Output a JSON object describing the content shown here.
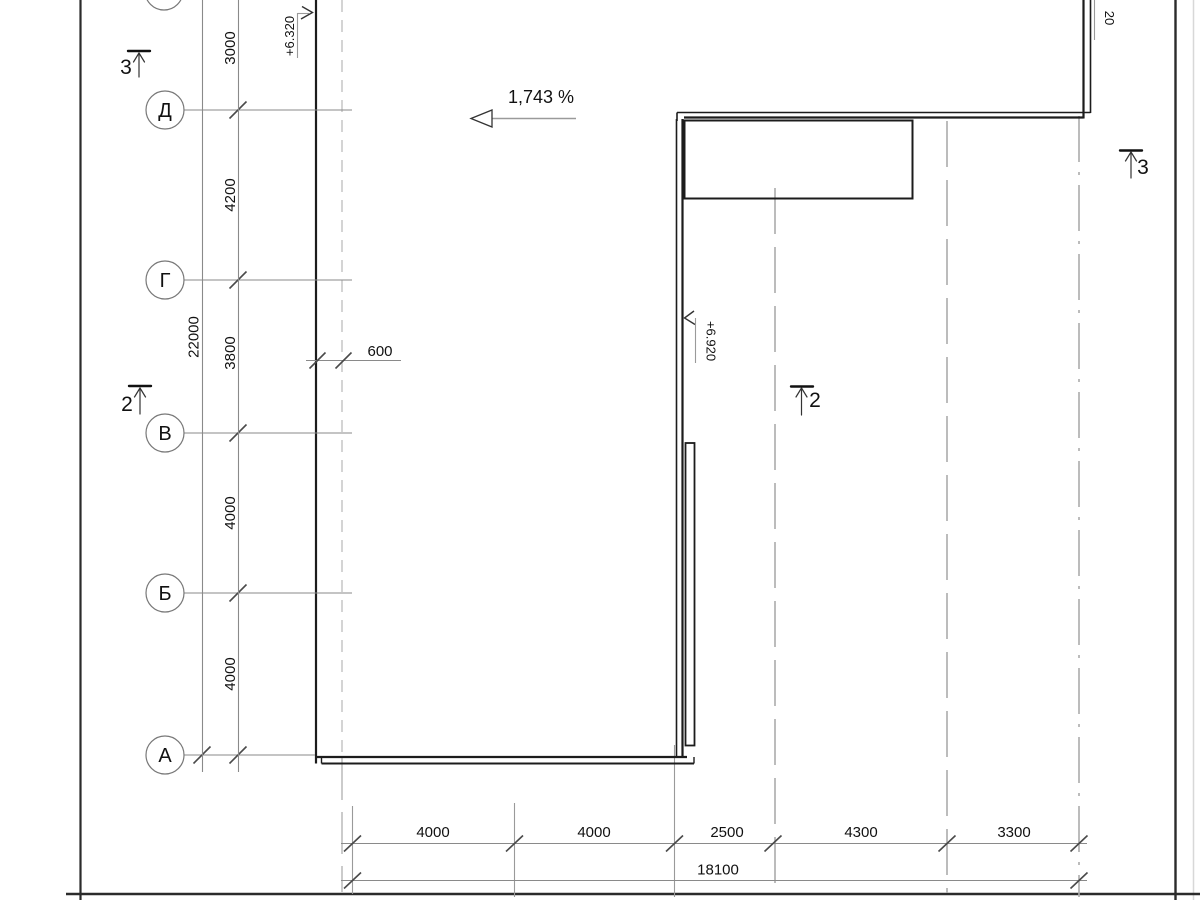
{
  "axes": {
    "row_labels": [
      "Д",
      "Г",
      "В",
      "Б",
      "А"
    ]
  },
  "left_dims": {
    "segments": [
      "3000",
      "4200",
      "3800",
      "4000",
      "4000"
    ],
    "total": "22000"
  },
  "offset_dim": "600",
  "bottom_dims": {
    "segments": [
      "4000",
      "4000",
      "2500",
      "4300",
      "3300"
    ],
    "total": "18100"
  },
  "slope": {
    "label": "1,743 %"
  },
  "elevations": {
    "left": "+6.320",
    "middle": "+6.920",
    "top_right_partial": "20"
  },
  "sections": {
    "top_left": "3",
    "left": "2",
    "middle": "2",
    "top_right": "3"
  }
}
